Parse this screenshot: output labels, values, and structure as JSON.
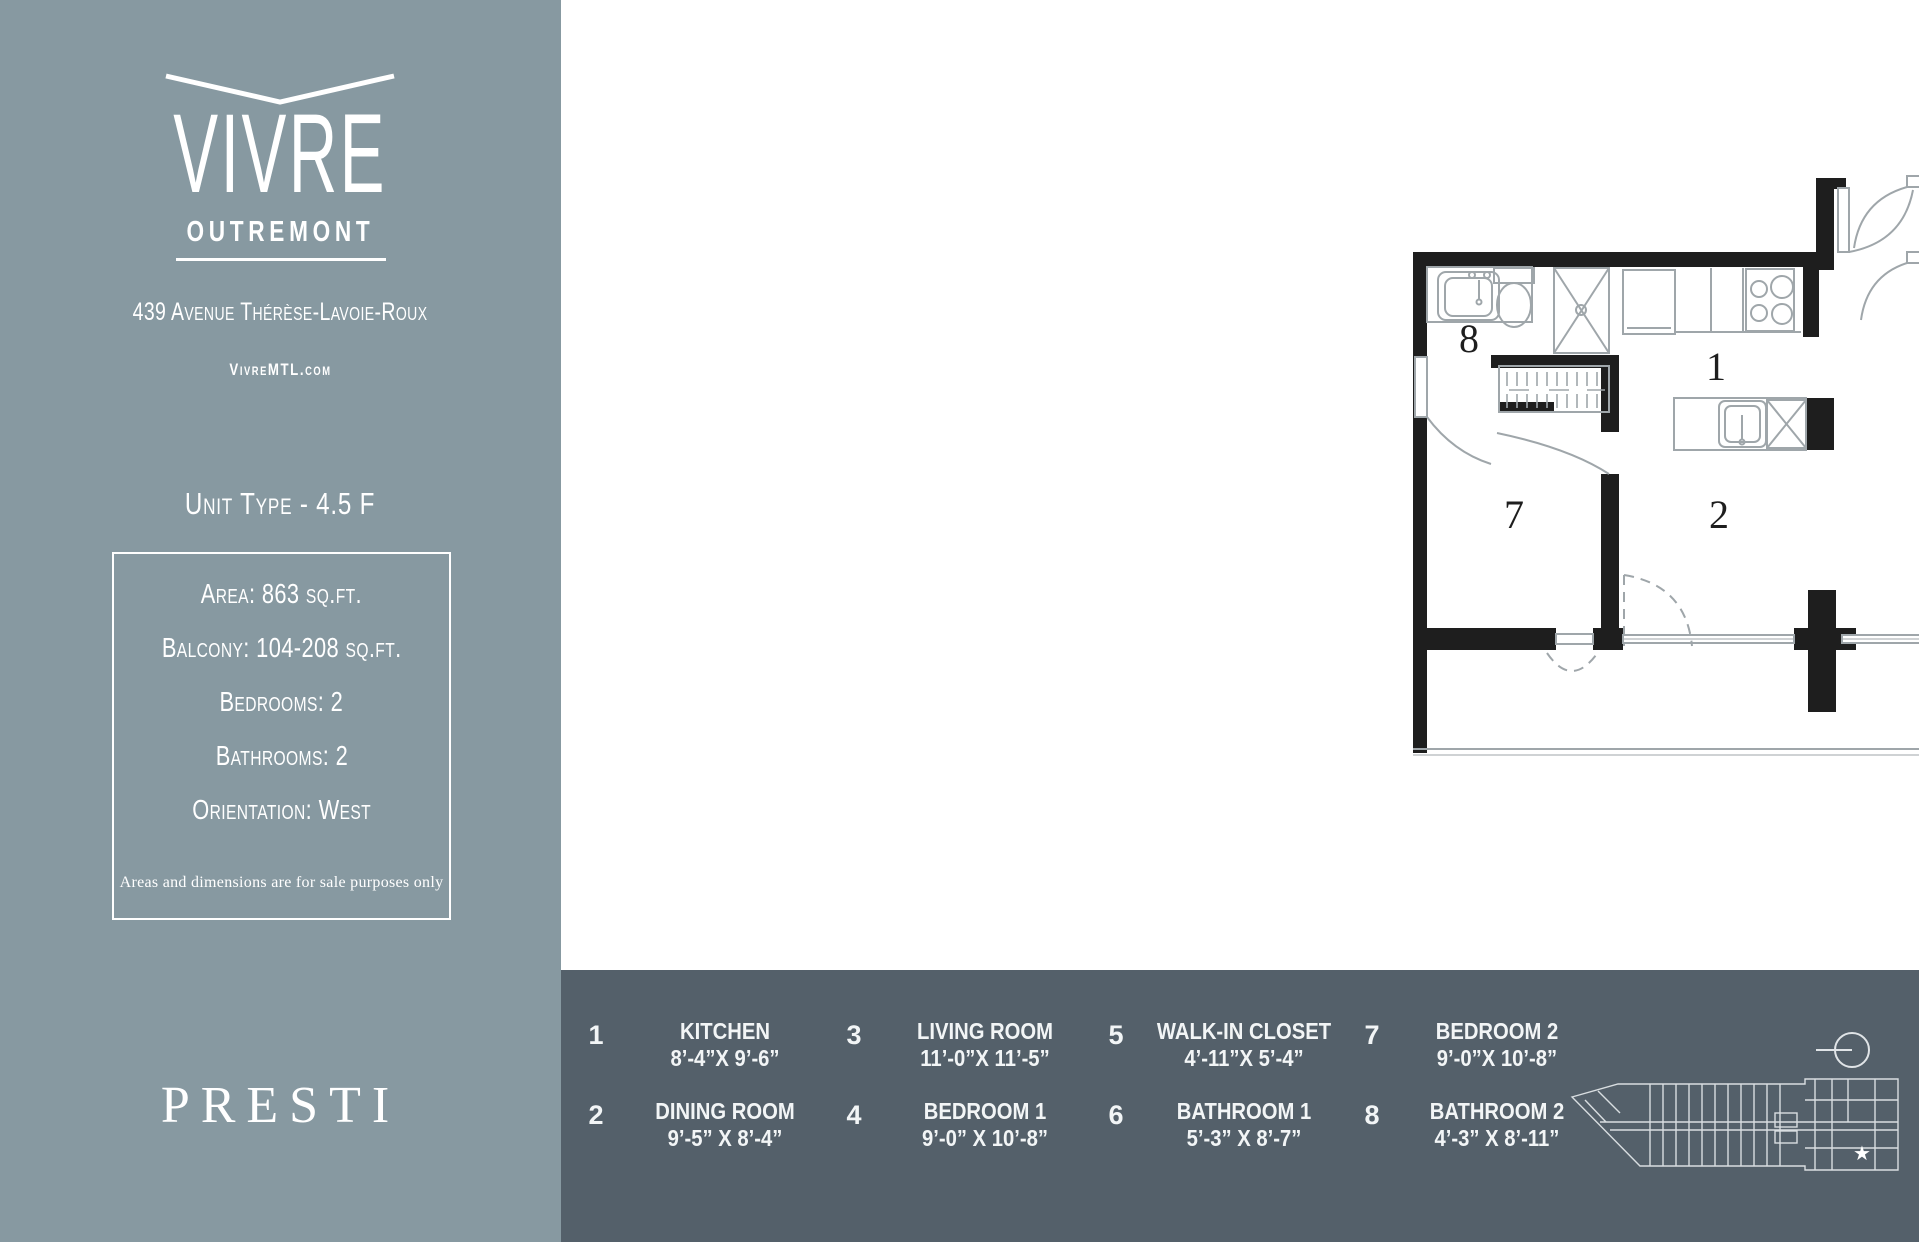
{
  "colors": {
    "sidebar_bg": "#8799A1",
    "footer_bg": "#54606A",
    "text_light": "#FFFFFF",
    "plan_wall": "#1E1E1E",
    "plan_thin_line": "#9FA6AA"
  },
  "sidebar": {
    "logo": {
      "title": "VIVRE",
      "subtitle": "OUTREMONT",
      "chevron_icon": "wide-v-chevron"
    },
    "address": "439 Avenue Thérèse-Lavoie-Roux",
    "website": "VivreMTL.com",
    "unit_type": "Unit Type - 4.5 F",
    "specs": [
      "Area: 863 sq.ft.",
      "Balcony: 104-208 sq.ft.",
      "Bedrooms: 2",
      "Bathrooms: 2",
      "Orientation: West"
    ],
    "disclaimer": "Areas and dimensions are for sale purposes only",
    "brand": "PRESTI"
  },
  "legend": {
    "items": [
      {
        "number": "1",
        "name": "KITCHEN",
        "dimensions": "8’-4”X 9’-6”"
      },
      {
        "number": "2",
        "name": "DINING ROOM",
        "dimensions": "9’-5” X 8’-4”"
      },
      {
        "number": "3",
        "name": "LIVING ROOM",
        "dimensions": "11’-0”X 11’-5”"
      },
      {
        "number": "4",
        "name": "BEDROOM 1",
        "dimensions": "9’-0” X 10’-8”"
      },
      {
        "number": "5",
        "name": "WALK-IN CLOSET",
        "dimensions": "4’-11”X 5’-4”"
      },
      {
        "number": "6",
        "name": "BATHROOM 1",
        "dimensions": "5’-3” X 8’-7”"
      },
      {
        "number": "7",
        "name": "BEDROOM 2",
        "dimensions": "9’-0”X 10’-8”"
      },
      {
        "number": "8",
        "name": "BATHROOM 2",
        "dimensions": "4’-3” X 8’-11”"
      }
    ],
    "column_order": [
      [
        "1",
        "2"
      ],
      [
        "3",
        "4"
      ],
      [
        "5",
        "6"
      ],
      [
        "7",
        "8"
      ]
    ]
  },
  "floor_plan": {
    "room_numbers": [
      "1",
      "2",
      "3",
      "4",
      "5",
      "6",
      "7",
      "8"
    ],
    "compass_icon": "west-orientation-circle",
    "site_plan": "building-footprint-with-unit-star"
  }
}
